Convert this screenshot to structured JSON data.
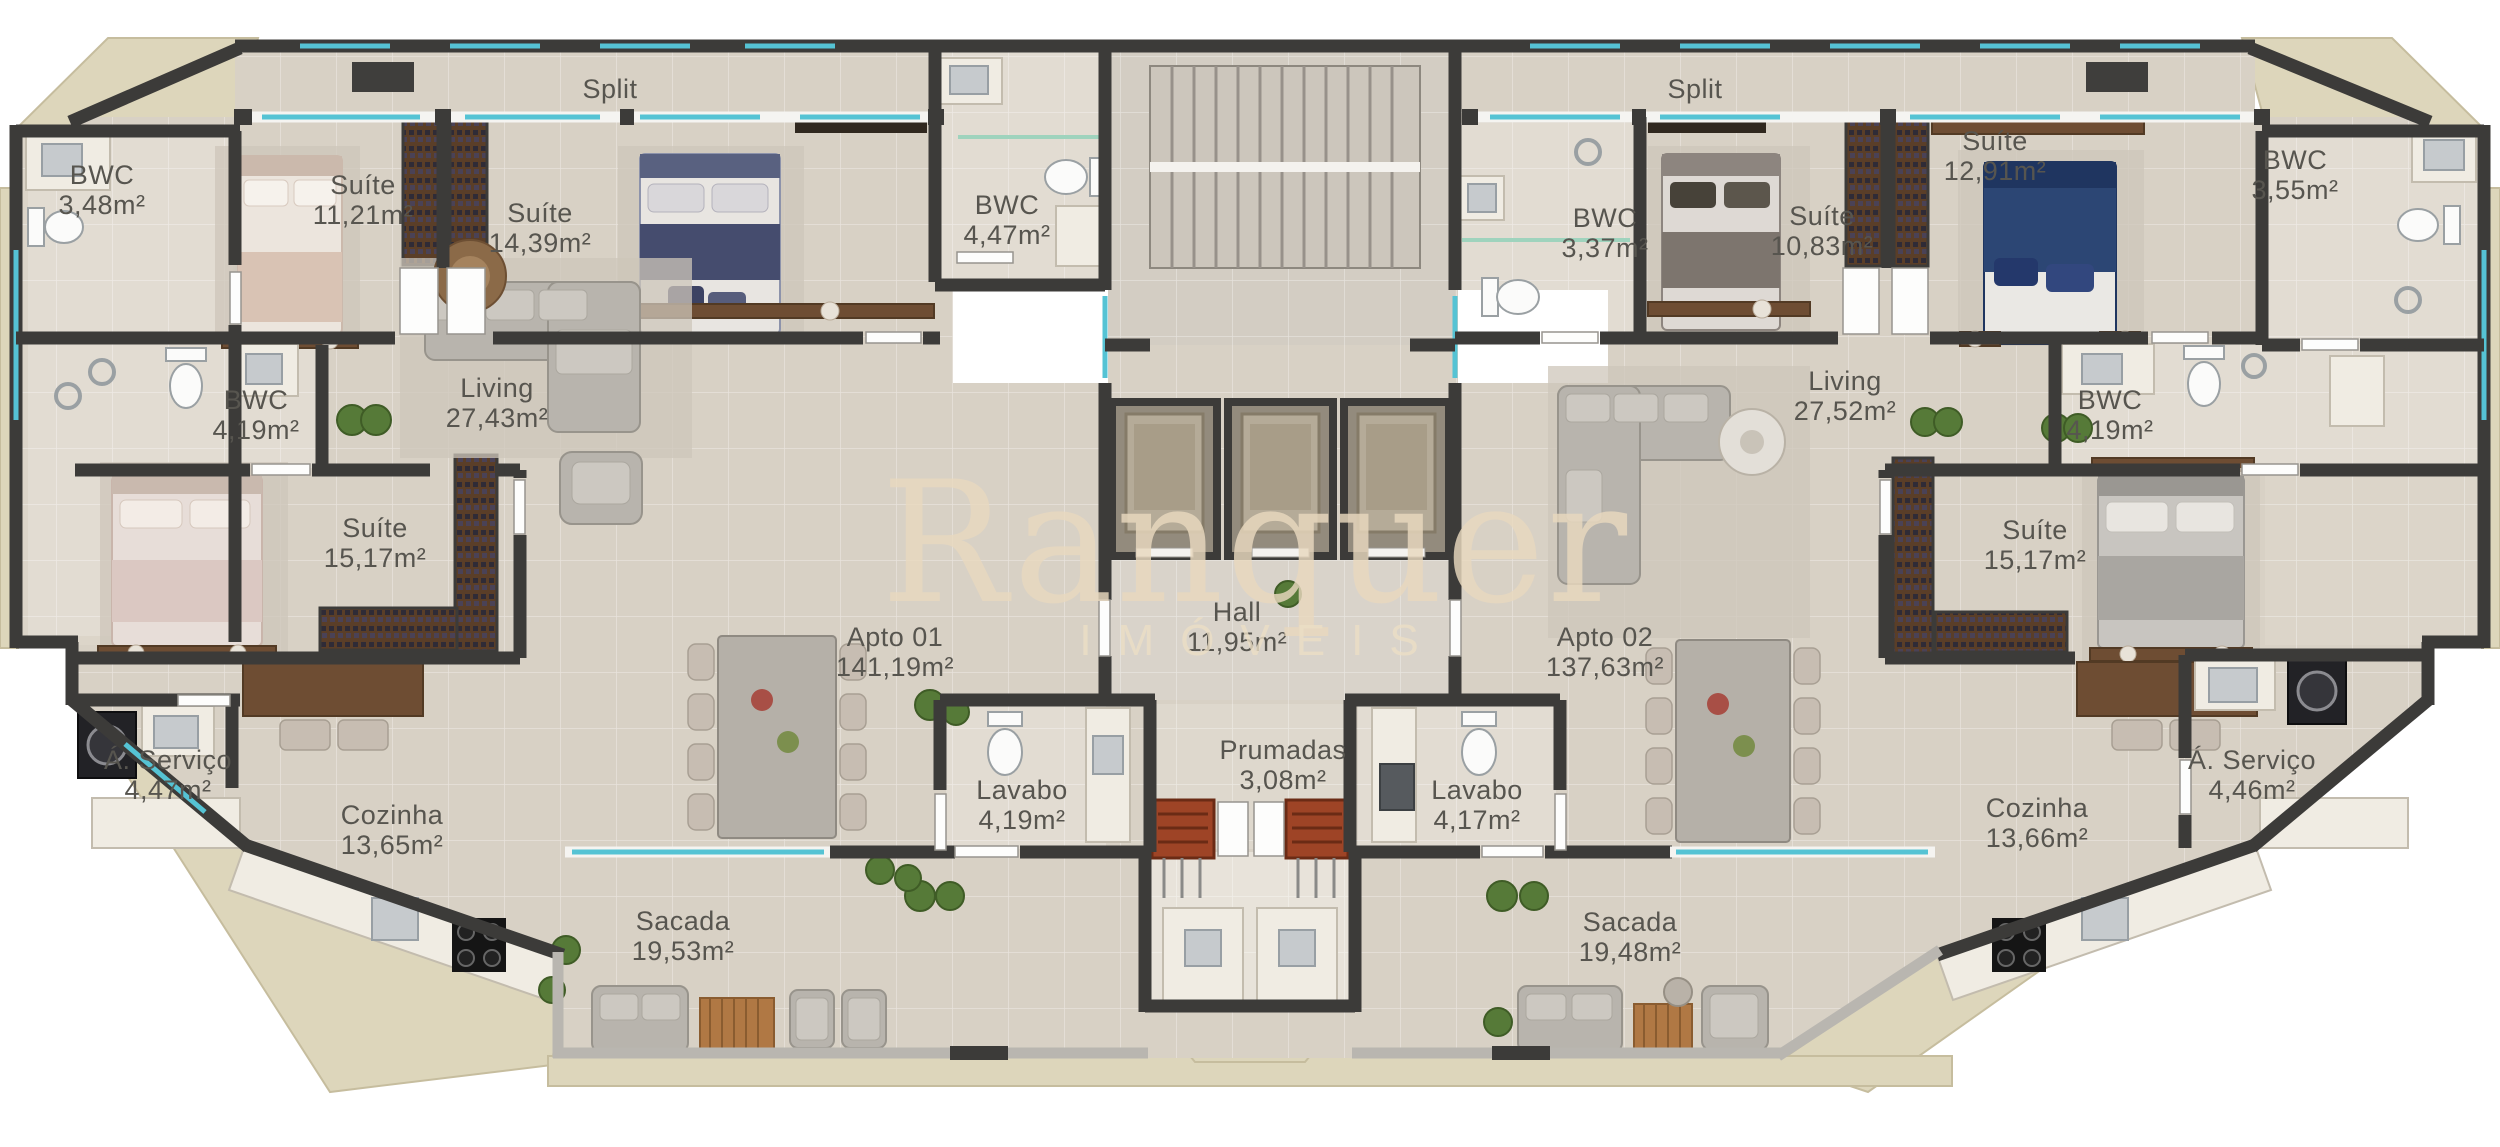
{
  "watermark": {
    "brand": "Ranquer",
    "subtitle": "IMÓVEIS"
  },
  "colors": {
    "wall": "#3c3b39",
    "floor": "#d8d1c5",
    "bathroom_floor": "#e2dcd2",
    "terrain": "#ddd6bb",
    "glass": "#55c3d4",
    "wood": "#6e4d33",
    "marble": "#f0ece3",
    "watermark": "#e9d9bf",
    "label_text": "#57554f"
  },
  "labels": {
    "split_left": {
      "name": "Split",
      "area": ""
    },
    "split_right": {
      "name": "Split",
      "area": ""
    },
    "bwc348": {
      "name": "BWC",
      "area": "3,48m²"
    },
    "suite1121": {
      "name": "Suíte",
      "area": "11,21m²"
    },
    "suite1439": {
      "name": "Suíte",
      "area": "14,39m²"
    },
    "bwc447": {
      "name": "BWC",
      "area": "4,47m²"
    },
    "bwc419L": {
      "name": "BWC",
      "area": "4,19m²"
    },
    "living1": {
      "name": "Living",
      "area": "27,43m²"
    },
    "suite1517L": {
      "name": "Suíte",
      "area": "15,17m²"
    },
    "servico1": {
      "name": "Á. Serviço",
      "area": "4,47m²"
    },
    "cozinha1": {
      "name": "Cozinha",
      "area": "13,65m²"
    },
    "lavabo1": {
      "name": "Lavabo",
      "area": "4,19m²"
    },
    "sacada1": {
      "name": "Sacada",
      "area": "19,53m²"
    },
    "apto1": {
      "name": "Apto 01",
      "area": "141,19m²"
    },
    "hall": {
      "name": "Hall",
      "area": "11,95m²"
    },
    "prumadas": {
      "name": "Prumadas",
      "area": "3,08m²"
    },
    "bwc337": {
      "name": "BWC",
      "area": "3,37m²"
    },
    "suite1083": {
      "name": "Suíte",
      "area": "10,83m²"
    },
    "suite1291": {
      "name": "Suíte",
      "area": "12,91m²"
    },
    "bwc355": {
      "name": "BWC",
      "area": "3,55m²"
    },
    "bwc419R": {
      "name": "BWC",
      "area": "4,19m²"
    },
    "living2": {
      "name": "Living",
      "area": "27,52m²"
    },
    "suite1517R": {
      "name": "Suíte",
      "area": "15,17m²"
    },
    "servico2": {
      "name": "Á. Serviço",
      "area": "4,46m²"
    },
    "cozinha2": {
      "name": "Cozinha",
      "area": "13,66m²"
    },
    "lavabo2": {
      "name": "Lavabo",
      "area": "4,17m²"
    },
    "sacada2": {
      "name": "Sacada",
      "area": "19,48m²"
    },
    "apto2": {
      "name": "Apto 02",
      "area": "137,63m²"
    }
  }
}
